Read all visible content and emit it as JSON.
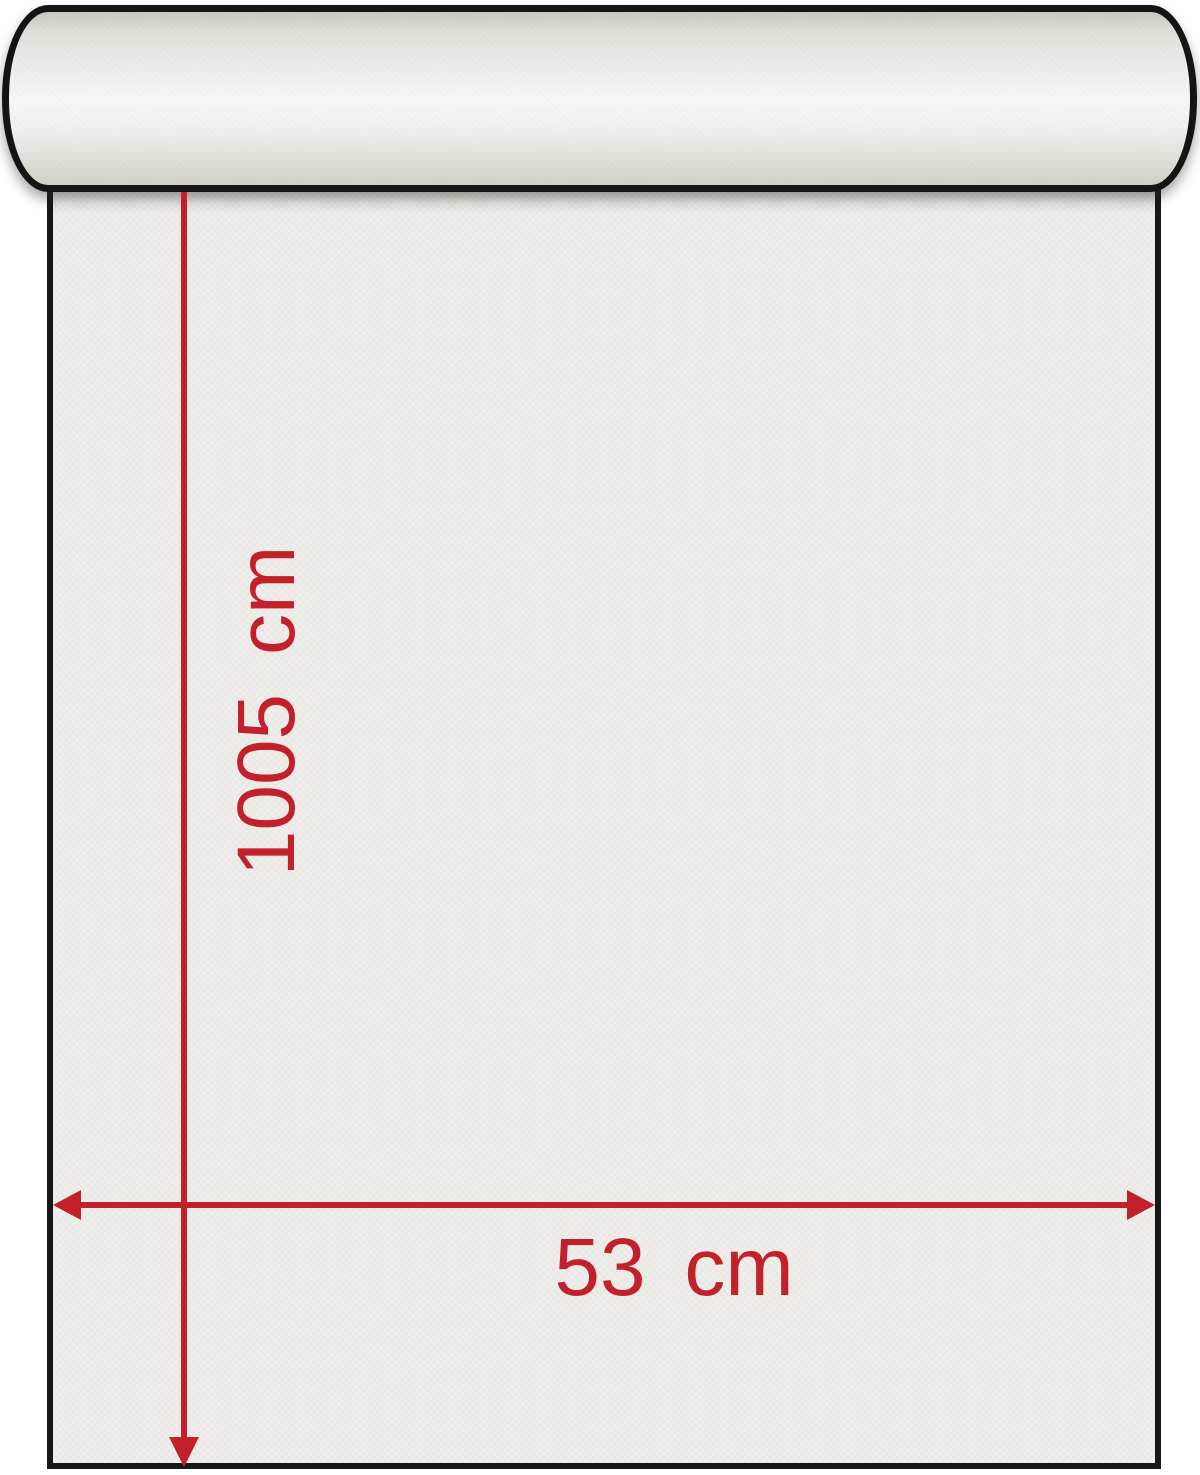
{
  "diagram": {
    "type": "wallpaper-roll-dimension-diagram",
    "height_label": "1005 cm",
    "width_label": "53 cm",
    "colors": {
      "dimension_red": "#c2202a",
      "outline_black": "#171717",
      "paper": "#f0eeea",
      "background": "#ffffff"
    }
  }
}
